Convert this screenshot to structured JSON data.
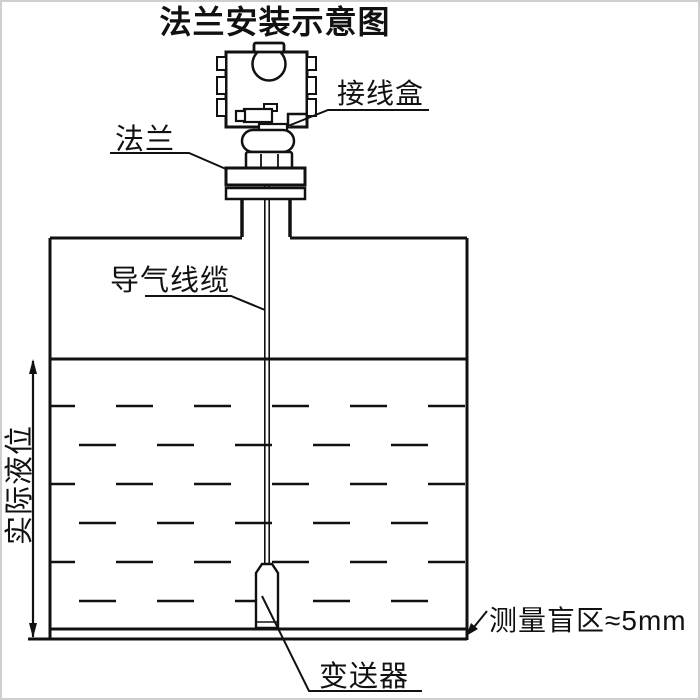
{
  "diagram": {
    "title": "法兰安装示意图",
    "labels": {
      "junction_box": "接线盒",
      "flange": "法兰",
      "air_cable": "导气线缆",
      "actual_level": "实际液位",
      "blind_zone": "测量盲区≈5mm",
      "transmitter": "变送器"
    },
    "colors": {
      "line": "#111111",
      "background": "#ffffff",
      "frame": "#cfcfcf"
    },
    "liquid": {
      "level_line_y": 359,
      "dash_rows": [
        406,
        445,
        484,
        523,
        562,
        601
      ],
      "blind_zone_gap_px": 10
    }
  }
}
